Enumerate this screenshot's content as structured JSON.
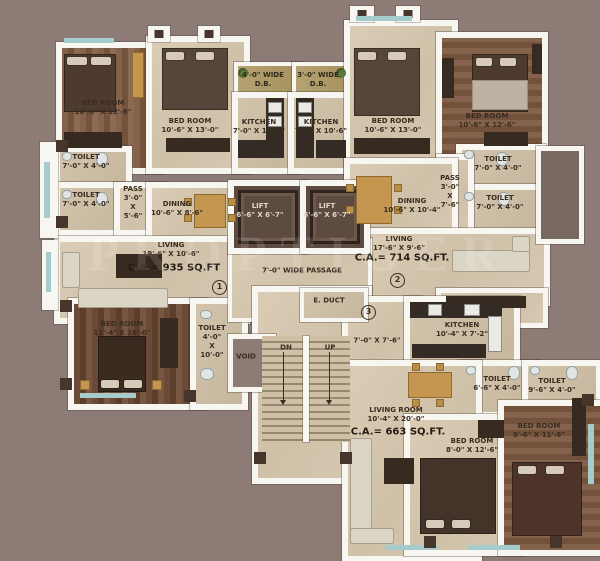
{
  "watermark": "PROPTIGER",
  "colors": {
    "background": "#8d7b76",
    "wall": "#f8f6f1",
    "tile_floor": "#d5c6af",
    "wood_floor": "#7c5a42",
    "accent_teal": "#a6cbcd",
    "dry_balcony_olive": "#aa9765",
    "label_text": "#3a2c20"
  },
  "flats": [
    {
      "marker": "1",
      "carpet_area": "C.A.= 935 SQ.FT",
      "dry_balcony": {
        "line1": "4'-0\" WIDE",
        "line2": "D.B."
      },
      "rooms": {
        "bedroom1": {
          "name": "BED ROOM",
          "dims": "10'-6\" X 12'-6\""
        },
        "bedroom2": {
          "name": "BED ROOM",
          "dims": "10'-6\" X 13'-0\""
        },
        "bedroom3": {
          "name": "BED ROOM",
          "dims": "11'-4\" X 16'-0\""
        },
        "kitchen": {
          "name": "KITCHEN",
          "dims": "7'-0\" X 10'-6\""
        },
        "toilet1": {
          "name": "TOILET",
          "dims": "7'-0\" X 4'-0\""
        },
        "toilet2": {
          "name": "TOILET",
          "dims": "7'-0\" X 4'-0\""
        },
        "toilet3": {
          "name": "TOILET",
          "dims": "4'-0\"\nX\n10'-0\""
        },
        "pass": {
          "name": "PASS",
          "dims": "3'-0\"\nX\n5'-6\""
        },
        "dining": {
          "name": "DINING",
          "dims": "10'-6\" X 8'-6\""
        },
        "living": {
          "name": "LIVING",
          "dims": "19'-6\" X 10'-6\""
        }
      }
    },
    {
      "marker": "2",
      "carpet_area": "C.A.= 714 SQ.FT.",
      "dry_balcony": {
        "line1": "3'-0\" WIDE",
        "line2": "D.B."
      },
      "rooms": {
        "bedroom1": {
          "name": "BED ROOM",
          "dims": "10'-6\" X 13'-0\""
        },
        "bedroom2": {
          "name": "BED ROOM",
          "dims": "10'-6\" X 12'-6\""
        },
        "kitchen": {
          "name": "KITCHEN",
          "dims": "7'-0\" X 10'-6\""
        },
        "toilet1": {
          "name": "TOILET",
          "dims": "7'-0\" X 4'-0\""
        },
        "toilet2": {
          "name": "TOILET",
          "dims": "7'-0\" X 4'-0\""
        },
        "pass": {
          "name": "PASS",
          "dims": "3'-0\"\nX\n7'-6\""
        },
        "dining": {
          "name": "DINING",
          "dims": "10'-6\" X 10'-4\""
        },
        "living": {
          "name": "LIVING",
          "dims": "17'-6\" X 9'-6\""
        }
      }
    },
    {
      "marker": "3",
      "carpet_area": "C.A.= 663 SQ.FT.",
      "rooms": {
        "kitchen": {
          "name": "KITCHEN",
          "dims": "10'-4\" X 7'-2\""
        },
        "lobby": {
          "name": "",
          "dims": "7'-0\" X 7'-6\""
        },
        "toilet1": {
          "name": "TOILET",
          "dims": "6'-6\" X 4'-0\""
        },
        "toilet2": {
          "name": "TOILET",
          "dims": "9'-6\" X 4'-0\""
        },
        "living": {
          "name": "LIVING ROOM",
          "dims": "10'-4\" X 20'-0\""
        },
        "bedroom1": {
          "name": "BED ROOM",
          "dims": "8'-0\" X 12'-6\""
        },
        "bedroom2": {
          "name": "BED ROOM",
          "dims": "9'-6\" X 11'-6\""
        }
      }
    }
  ],
  "common": {
    "lift1": {
      "name": "LIFT",
      "dims": "6'-6\" X 6'-7\""
    },
    "lift2": {
      "name": "LIFT",
      "dims": "6'-6\" X 6'-7\""
    },
    "passage": "7'-0\" WIDE PASSAGE",
    "e_duct": "E. DUCT",
    "void": "VOID",
    "stair_down": "DN",
    "stair_up": "UP"
  }
}
